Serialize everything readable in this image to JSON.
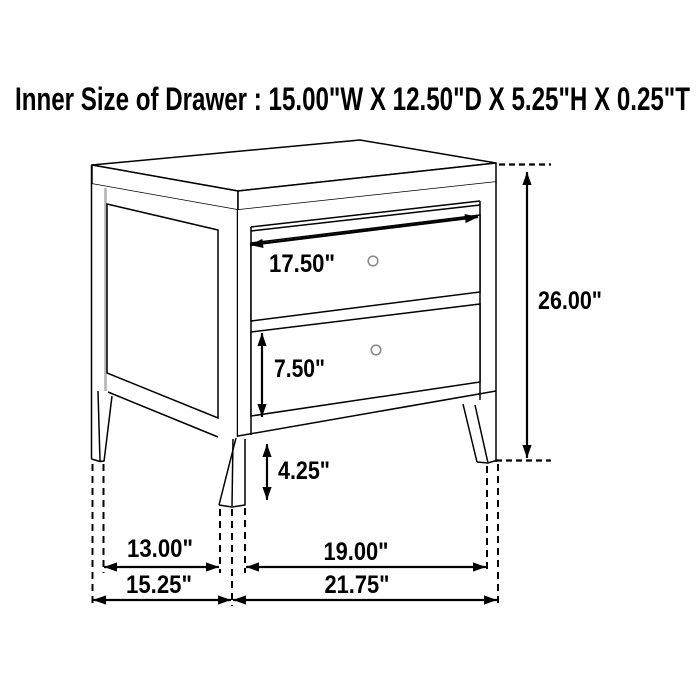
{
  "colors": {
    "background": "#ffffff",
    "line": "#000000",
    "knob": "#8c8c8c",
    "panel_shade": "#b4b4b4",
    "text": "#000000"
  },
  "title": "Inner Size of Drawer : 15.00\"W X 12.50\"D X 5.25\"H X 0.25\"T",
  "figure": {
    "item": "two-drawer nightstand dimension drawing",
    "labels": {
      "drawer_width": "17.50\"",
      "overall_height": "26.00\"",
      "bottom_drawer_height": "7.50\"",
      "leg_height": "4.25\"",
      "depth_inner": "13.00\"",
      "depth_overall": "15.25\"",
      "width_inner": "19.00\"",
      "width_overall": "21.75\""
    }
  }
}
